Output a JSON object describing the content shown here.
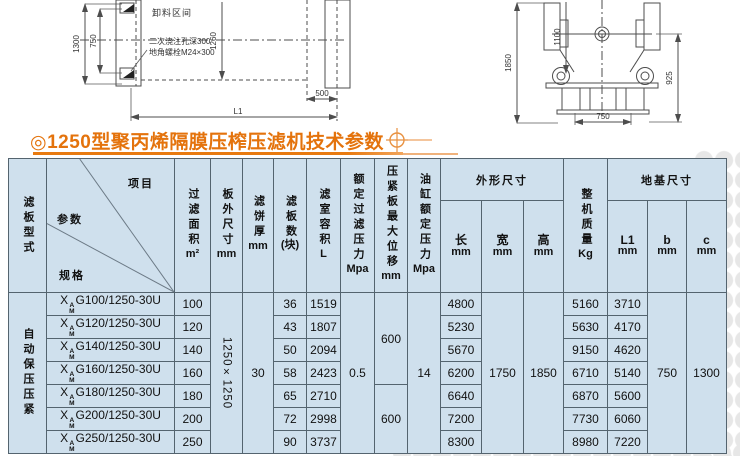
{
  "title": {
    "bullet_text": "◎1250型聚丙烯隔膜压榨压滤机技术参数"
  },
  "colors": {
    "accent_orange": "#e4730c",
    "table_cell_bg": "#cfe0ed",
    "table_border": "#54646f",
    "drawing_line": "#4d4d4d",
    "dot_watermark": "#e7e7e7"
  },
  "drawings": {
    "left": {
      "unload_zone": "卸料区间",
      "note1": "二次浇注孔深300",
      "note2": "地角螺栓M24×300",
      "dim_height": "1300",
      "dim_bolt_span": "750",
      "dim_inner": "1260",
      "dim_offset": "500",
      "dim_length": "L1"
    },
    "right": {
      "dim_height": "1850",
      "dim_hub": "1100",
      "dim_base_h": "925",
      "dim_base_w": "750"
    }
  },
  "table": {
    "header": {
      "plate_type": "滤板型式",
      "diag": {
        "item": "项目",
        "param": "参数",
        "spec": "规格"
      },
      "area": {
        "label": "过滤面积",
        "unit": "m²"
      },
      "plate_size": {
        "label": "板外尺寸",
        "unit": "mm"
      },
      "cake": {
        "label": "滤饼厚",
        "unit": "mm"
      },
      "plates": {
        "label": "滤板数",
        "unit": "(块)"
      },
      "volume": {
        "label": "滤室容积",
        "unit": "L"
      },
      "filter_pressure": {
        "label": "额定过滤压力",
        "unit": "Mpa"
      },
      "displacement": {
        "label": "压紧板最大位移",
        "unit": "mm"
      },
      "cylinder_pressure": {
        "label": "油缸额定压力",
        "unit": "Mpa"
      },
      "dims_group": "外形尺寸",
      "length": {
        "label": "长",
        "unit": "mm"
      },
      "width": {
        "label": "宽",
        "unit": "mm"
      },
      "height": {
        "label": "高",
        "unit": "mm"
      },
      "weight": {
        "label": "整机质量",
        "unit": "Kg"
      },
      "foundation_group": "地基尺寸",
      "l1": {
        "label": "L1",
        "unit": "mm"
      },
      "b": {
        "label": "b",
        "unit": "mm"
      },
      "c": {
        "label": "c",
        "unit": "mm"
      }
    },
    "body": {
      "plate_type": "自动保压压紧",
      "plate_size": "1250×1250",
      "cake": "30",
      "filter_pressure": "0.5",
      "displacement_top": "600",
      "displacement_bottom": "600",
      "cylinder_pressure": "14",
      "width": "1750",
      "height": "1850",
      "b": "750",
      "c": "1300",
      "rows": [
        {
          "spec_x": "X",
          "spec_sup": "A",
          "spec_sub": "M",
          "spec_body": "G100/1250-30U",
          "area": "100",
          "plates": "36",
          "volume": "1519",
          "length": "4800",
          "weight": "5160",
          "l1": "3710"
        },
        {
          "spec_x": "X",
          "spec_sup": "A",
          "spec_sub": "M",
          "spec_body": "G120/1250-30U",
          "area": "120",
          "plates": "43",
          "volume": "1807",
          "length": "5230",
          "weight": "5630",
          "l1": "4170"
        },
        {
          "spec_x": "X",
          "spec_sup": "A",
          "spec_sub": "M",
          "spec_body": "G140/1250-30U",
          "area": "140",
          "plates": "50",
          "volume": "2094",
          "length": "5670",
          "weight": "9150",
          "l1": "4620"
        },
        {
          "spec_x": "X",
          "spec_sup": "A",
          "spec_sub": "M",
          "spec_body": "G160/1250-30U",
          "area": "160",
          "plates": "58",
          "volume": "2423",
          "length": "6200",
          "weight": "6710",
          "l1": "5140"
        },
        {
          "spec_x": "X",
          "spec_sup": "A",
          "spec_sub": "M",
          "spec_body": "G180/1250-30U",
          "area": "180",
          "plates": "65",
          "volume": "2710",
          "length": "6640",
          "weight": "6870",
          "l1": "5600"
        },
        {
          "spec_x": "X",
          "spec_sup": "A",
          "spec_sub": "M",
          "spec_body": "G200/1250-30U",
          "area": "200",
          "plates": "72",
          "volume": "2998",
          "length": "7200",
          "weight": "7730",
          "l1": "6060"
        },
        {
          "spec_x": "X",
          "spec_sup": "A",
          "spec_sub": "M",
          "spec_body": "G250/1250-30U",
          "area": "250",
          "plates": "90",
          "volume": "3737",
          "length": "8300",
          "weight": "8980",
          "l1": "7220"
        }
      ]
    }
  }
}
